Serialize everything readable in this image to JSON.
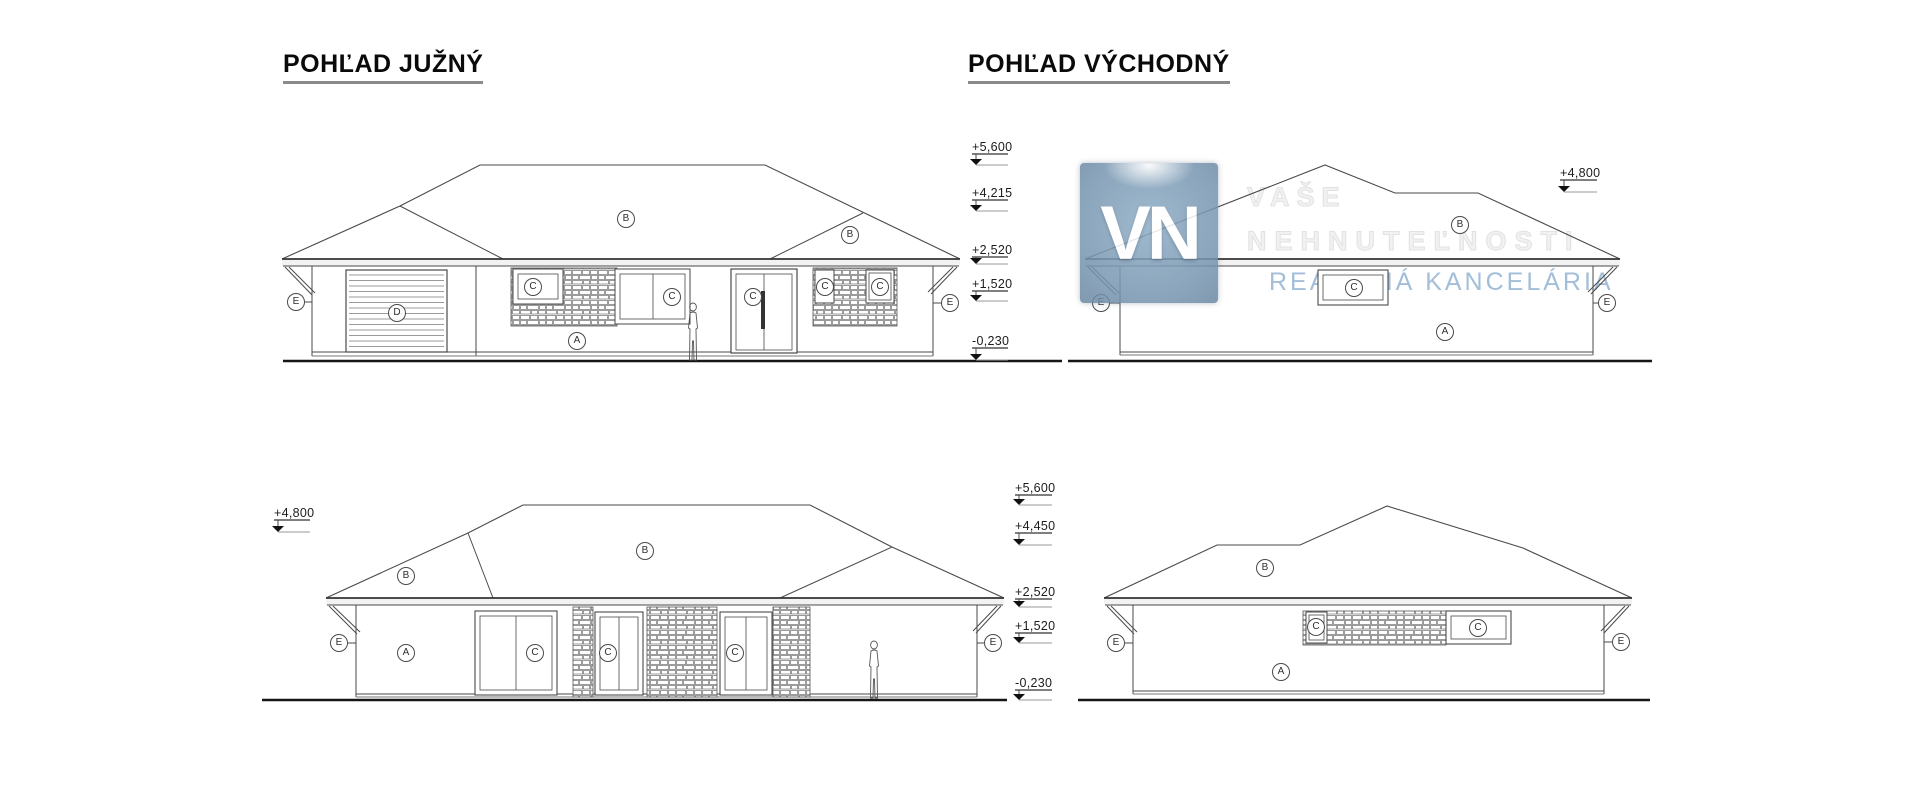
{
  "page": {
    "background": "#ffffff"
  },
  "titles": {
    "south": "POHĽAD JUŽNÝ",
    "east": "POHĽAD VÝCHODNÝ"
  },
  "watermark": {
    "logo_text": "VN",
    "tagline_line1": "VAŠE",
    "tagline_line2": "NEHNUTEĽNOSTI",
    "tagline_line3": "REALITNÁ KANCELÁRIA",
    "tagline_color": "#a2bed9",
    "logo_color": "#7695b0"
  },
  "views": {
    "south": {
      "markers": [
        "+5,600",
        "+4,215",
        "+2,520",
        "+1,520",
        "-0,230"
      ],
      "labels": [
        "E",
        "D",
        "C",
        "C",
        "C",
        "C",
        "C",
        "A",
        "B",
        "B",
        "E"
      ]
    },
    "east": {
      "markers": [
        "+4,800"
      ],
      "labels": [
        "E",
        "C",
        "B",
        "A",
        "E"
      ]
    },
    "north": {
      "marker_left": "+4,800",
      "markers": [
        "+5,600",
        "+4,450",
        "+2,520",
        "+1,520",
        "-0,230"
      ],
      "labels": [
        "E",
        "C",
        "C",
        "C",
        "A",
        "B",
        "B",
        "E"
      ]
    },
    "west": {
      "labels": [
        "E",
        "C",
        "C",
        "A",
        "B",
        "E"
      ]
    }
  }
}
